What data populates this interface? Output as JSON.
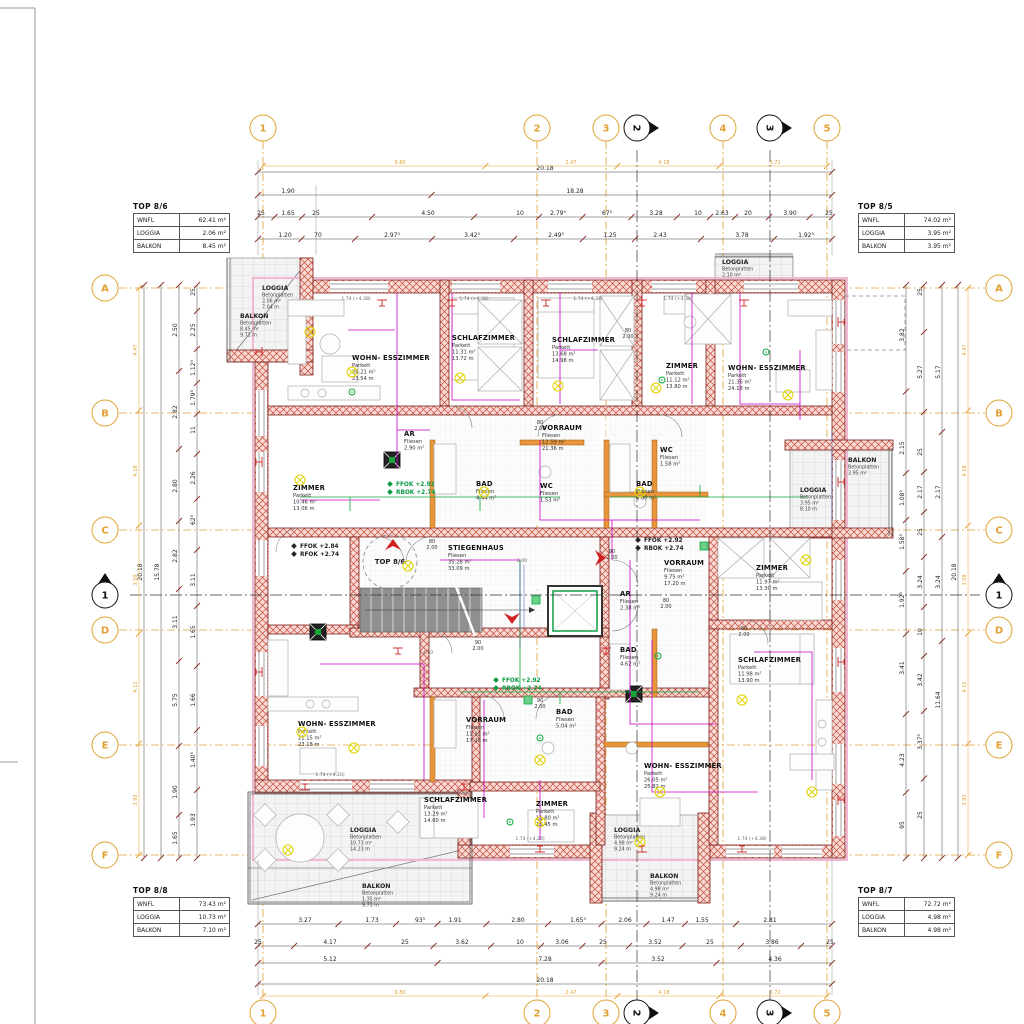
{
  "axes": {
    "cols": [
      {
        "label": "1",
        "x": 263
      },
      {
        "label": "2",
        "x": 537
      },
      {
        "label": "3",
        "x": 606
      },
      {
        "label": "4",
        "x": 723
      },
      {
        "label": "5",
        "x": 827
      }
    ],
    "rows": [
      {
        "label": "A",
        "y": 288
      },
      {
        "label": "B",
        "y": 413
      },
      {
        "label": "C",
        "y": 530
      },
      {
        "label": "D",
        "y": 630
      },
      {
        "label": "E",
        "y": 745
      },
      {
        "label": "F",
        "y": 855
      }
    ],
    "sections": [
      {
        "label": "1",
        "type": "h",
        "pos": 595
      },
      {
        "label": "2",
        "type": "v",
        "pos": 637
      },
      {
        "label": "3",
        "type": "v",
        "pos": 770
      }
    ]
  },
  "tables": [
    {
      "title": "TOP 8/6",
      "rows": [
        {
          "k": "WNFL",
          "v": "62.41 m²"
        },
        {
          "k": "LOGGIA",
          "v": "2.06 m²"
        },
        {
          "k": "BALKON",
          "v": "8.45 m²"
        }
      ]
    },
    {
      "title": "TOP 8/5",
      "rows": [
        {
          "k": "WNFL",
          "v": "74.02 m²"
        },
        {
          "k": "LOGGIA",
          "v": "3.95 m²"
        },
        {
          "k": "BALKON",
          "v": "3.95 m²"
        }
      ]
    },
    {
      "title": "TOP 8/8",
      "rows": [
        {
          "k": "WNFL",
          "v": "73.43 m²"
        },
        {
          "k": "LOGGIA",
          "v": "10.73 m²"
        },
        {
          "k": "BALKON",
          "v": "7.10 m²"
        }
      ]
    },
    {
      "title": "TOP 8/7",
      "rows": [
        {
          "k": "WNFL",
          "v": "72.72 m²"
        },
        {
          "k": "LOGGIA",
          "v": "4.98 m²"
        },
        {
          "k": "BALKON",
          "v": "4.98 m²"
        }
      ]
    }
  ],
  "rooms": [
    {
      "name": "WOHN- ESSZIMMER",
      "lines": [
        "Parkett",
        "26.21 m²",
        "23.54 m"
      ],
      "x": 352,
      "y": 360
    },
    {
      "name": "SCHLAFZIMMER",
      "lines": [
        "Parkett",
        "11.31 m²",
        "13.72 m"
      ],
      "x": 452,
      "y": 340
    },
    {
      "name": "SCHLAFZIMMER",
      "lines": [
        "Parkett",
        "13.68 m²",
        "14.98 m"
      ],
      "x": 552,
      "y": 342
    },
    {
      "name": "ZIMMER",
      "lines": [
        "Parkett",
        "11.12 m²",
        "13.80 m"
      ],
      "x": 666,
      "y": 368
    },
    {
      "name": "WOHN- ESSZIMMER",
      "lines": [
        "Parkett",
        "21.36 m²",
        "24.18 m"
      ],
      "x": 728,
      "y": 370
    },
    {
      "name": "ZIMMER",
      "lines": [
        "Parkett",
        "10.46 m²",
        "13.06 m"
      ],
      "x": 293,
      "y": 490
    },
    {
      "name": "VORRAUM",
      "lines": [
        "Fliesen",
        "12.59 m²",
        "21.36 m"
      ],
      "x": 542,
      "y": 430
    },
    {
      "name": "VORRAUM",
      "lines": [
        "Fliesen",
        "9.75 m²",
        "17.20 m"
      ],
      "x": 664,
      "y": 565
    },
    {
      "name": "ZIMMER",
      "lines": [
        "Parkett",
        "11.97 m²",
        "13.30 m"
      ],
      "x": 756,
      "y": 570
    },
    {
      "name": "STIEGENHAUS",
      "lines": [
        "Fliesen",
        "35.28 m²",
        "33.09 m"
      ],
      "x": 448,
      "y": 550
    },
    {
      "name": "VORRAUM",
      "lines": [
        "Fliesen",
        "11.32 m²",
        "17.20 m"
      ],
      "x": 466,
      "y": 722
    },
    {
      "name": "WOHN- ESSZIMMER",
      "lines": [
        "Parkett",
        "21.15 m²",
        "23.18 m"
      ],
      "x": 298,
      "y": 726
    },
    {
      "name": "SCHLAFZIMMER",
      "lines": [
        "Parkett",
        "11.98 m²",
        "13.90 m"
      ],
      "x": 738,
      "y": 662
    },
    {
      "name": "WOHN- ESSZIMMER",
      "lines": [
        "Parkett",
        "26.05 m²",
        "25.82 m"
      ],
      "x": 644,
      "y": 768
    },
    {
      "name": "SCHLAFZIMMER",
      "lines": [
        "Parkett",
        "13.29 m²",
        "14.60 m"
      ],
      "x": 424,
      "y": 802
    },
    {
      "name": "ZIMMER",
      "lines": [
        "Parkett",
        "11.80 m²",
        "13.45 m"
      ],
      "x": 536,
      "y": 806
    },
    {
      "name": "BAD",
      "lines": [
        "Fliesen",
        "4.44 m²"
      ],
      "x": 476,
      "y": 486
    },
    {
      "name": "WC",
      "lines": [
        "Fliesen",
        "1.53 m²"
      ],
      "x": 540,
      "y": 488
    },
    {
      "name": "BAD",
      "lines": [
        "Fliesen",
        "4.80 m²"
      ],
      "x": 636,
      "y": 486
    },
    {
      "name": "AR",
      "lines": [
        "Fliesen",
        "2.38 m²"
      ],
      "x": 620,
      "y": 596
    },
    {
      "name": "BAD",
      "lines": [
        "Fliesen",
        "5.04 m²"
      ],
      "x": 556,
      "y": 714
    },
    {
      "name": "BAD",
      "lines": [
        "Fliesen",
        "4.62 m²"
      ],
      "x": 620,
      "y": 652
    },
    {
      "name": "AR",
      "lines": [
        "Fliesen",
        "2.90 m²"
      ],
      "x": 404,
      "y": 436
    },
    {
      "name": "WC",
      "lines": [
        "Fliesen",
        "1.58 m²"
      ],
      "x": 660,
      "y": 452
    }
  ],
  "loggias": [
    {
      "name": "LOGGIA",
      "lines": [
        "Betonplatten",
        "2.06 m²",
        "7.04 m"
      ],
      "x": 262,
      "y": 290
    },
    {
      "name": "BALKON",
      "lines": [
        "Betonplatten",
        "8.45 m²",
        "9.71 m"
      ],
      "x": 240,
      "y": 318
    },
    {
      "name": "LOGGIA",
      "lines": [
        "Betonplatten",
        "3.95 m²",
        "8.10 m"
      ],
      "x": 800,
      "y": 492
    },
    {
      "name": "BALKON",
      "lines": [
        "Betonplatten",
        "3.95 m²"
      ],
      "x": 848,
      "y": 462
    },
    {
      "name": "LOGGIA",
      "lines": [
        "Betonplatten",
        "10.73 m²",
        "14.23 m"
      ],
      "x": 350,
      "y": 832
    },
    {
      "name": "BALKON",
      "lines": [
        "Betonplatten",
        "1.35 m²",
        "9.71 m"
      ],
      "x": 362,
      "y": 888
    },
    {
      "name": "LOGGIA",
      "lines": [
        "Betonplatten",
        "4.98 m²",
        "9.24 m"
      ],
      "x": 614,
      "y": 832
    },
    {
      "name": "BALKON",
      "lines": [
        "Betonplatten",
        "4.98 m²",
        "9.24 m"
      ],
      "x": 650,
      "y": 878
    },
    {
      "name": "LOGGIA",
      "lines": [
        "Betonplatten",
        "2.10 m²"
      ],
      "x": 722,
      "y": 264
    }
  ],
  "annotations": [
    {
      "lines": [
        "FFOK +2.92",
        "RBOK +2.74"
      ],
      "x": 396,
      "y": 486,
      "color": "#0B9A44"
    },
    {
      "lines": [
        "FFOK +2.84",
        "RFOK +2.74"
      ],
      "x": 300,
      "y": 548,
      "color": "#222222"
    },
    {
      "lines": [
        "FFOK +2.92",
        "RBOK +2.74"
      ],
      "x": 644,
      "y": 542,
      "color": "#222222"
    },
    {
      "lines": [
        "FFOK +2.92",
        "RBOK +2.74"
      ],
      "x": 502,
      "y": 682,
      "color": "#0B9A44"
    }
  ],
  "entry_label": {
    "label": "TOP 8/6",
    "x": 390,
    "y": 562
  },
  "dims_top": [
    {
      "y": 172,
      "x1": 258,
      "x2": 832,
      "items": [
        {
          "t": "20.18",
          "x": 545
        }
      ]
    },
    {
      "y": 195,
      "x1": 258,
      "x2": 832,
      "items": [
        {
          "t": "1.90",
          "x": 288
        },
        {
          "t": "18.28",
          "x": 575
        }
      ]
    },
    {
      "y": 217,
      "x1": 258,
      "x2": 832,
      "items": [
        {
          "t": "25",
          "x": 261
        },
        {
          "t": "1.65",
          "x": 288
        },
        {
          "t": "25",
          "x": 316
        },
        {
          "t": "4.50",
          "x": 428
        },
        {
          "t": "10",
          "x": 520
        },
        {
          "t": "2.79⁵",
          "x": 558
        },
        {
          "t": "67⁵",
          "x": 607
        },
        {
          "t": "3.28",
          "x": 656
        },
        {
          "t": "10",
          "x": 698
        },
        {
          "t": "2.63",
          "x": 722
        },
        {
          "t": "20",
          "x": 748
        },
        {
          "t": "3.90",
          "x": 790
        },
        {
          "t": "25",
          "x": 829
        }
      ]
    },
    {
      "y": 239,
      "x1": 258,
      "x2": 832,
      "items": [
        {
          "t": "1.20",
          "x": 285
        },
        {
          "t": "70",
          "x": 318
        },
        {
          "t": "2.97⁵",
          "x": 392
        },
        {
          "t": "3.42⁵",
          "x": 472
        },
        {
          "t": "2.49⁵",
          "x": 556
        },
        {
          "t": "1.25",
          "x": 610
        },
        {
          "t": "2.43",
          "x": 660
        },
        {
          "t": "3.78",
          "x": 742
        },
        {
          "t": "1.92⁵",
          "x": 806
        }
      ]
    }
  ],
  "dims_bottom": [
    {
      "y": 924,
      "x1": 258,
      "x2": 832,
      "items": [
        {
          "t": "3.27",
          "x": 305
        },
        {
          "t": "1.73",
          "x": 372
        },
        {
          "t": "93⁵",
          "x": 420
        },
        {
          "t": "1.91",
          "x": 455
        },
        {
          "t": "2.80",
          "x": 518
        },
        {
          "t": "1.65⁵",
          "x": 578
        },
        {
          "t": "2.06",
          "x": 625
        },
        {
          "t": "1.47",
          "x": 668
        },
        {
          "t": "1.55",
          "x": 702
        },
        {
          "t": "2.81",
          "x": 770
        }
      ]
    },
    {
      "y": 946,
      "x1": 258,
      "x2": 832,
      "items": [
        {
          "t": "25",
          "x": 258
        },
        {
          "t": "4.17",
          "x": 330
        },
        {
          "t": "25",
          "x": 405
        },
        {
          "t": "3.62",
          "x": 462
        },
        {
          "t": "10",
          "x": 520
        },
        {
          "t": "3.06",
          "x": 562
        },
        {
          "t": "25",
          "x": 603
        },
        {
          "t": "3.52",
          "x": 655
        },
        {
          "t": "25",
          "x": 710
        },
        {
          "t": "3.86",
          "x": 772
        },
        {
          "t": "25",
          "x": 830
        }
      ]
    },
    {
      "y": 963,
      "x1": 258,
      "x2": 832,
      "items": [
        {
          "t": "5.12",
          "x": 330
        },
        {
          "t": "7.28",
          "x": 545
        },
        {
          "t": "3.52",
          "x": 658
        },
        {
          "t": "4.36",
          "x": 775
        }
      ]
    },
    {
      "y": 984,
      "x1": 258,
      "x2": 832,
      "items": [
        {
          "t": "20.18",
          "x": 545
        }
      ]
    }
  ],
  "dims_left": [
    {
      "x": 144,
      "y1": 285,
      "y2": 858,
      "items": [
        {
          "t": "20.18",
          "y": 572
        }
      ]
    },
    {
      "x": 161,
      "y1": 285,
      "y2": 858,
      "items": [
        {
          "t": "15.78",
          "y": 572
        }
      ]
    },
    {
      "x": 179,
      "y1": 285,
      "y2": 858,
      "items": [
        {
          "t": "2.50",
          "y": 330
        },
        {
          "t": "2.82",
          "y": 412
        },
        {
          "t": "2.80",
          "y": 486
        },
        {
          "t": "2.82",
          "y": 556
        },
        {
          "t": "3.11",
          "y": 622
        },
        {
          "t": "5.75",
          "y": 700
        },
        {
          "t": "1.90",
          "y": 792
        },
        {
          "t": "1.65",
          "y": 838
        }
      ]
    },
    {
      "x": 197,
      "y1": 285,
      "y2": 858,
      "items": [
        {
          "t": "25",
          "y": 292
        },
        {
          "t": "2.25",
          "y": 330
        },
        {
          "t": "1.12⁵",
          "y": 368
        },
        {
          "t": "1.79⁵",
          "y": 398
        },
        {
          "t": "11",
          "y": 430
        },
        {
          "t": "2.26",
          "y": 478
        },
        {
          "t": "62⁵",
          "y": 520
        },
        {
          "t": "3.11",
          "y": 580
        },
        {
          "t": "1.65",
          "y": 632
        },
        {
          "t": "1.66",
          "y": 700
        },
        {
          "t": "1.40⁵",
          "y": 760
        },
        {
          "t": "1.93",
          "y": 820
        }
      ]
    }
  ],
  "dims_right": [
    {
      "x": 906,
      "y1": 285,
      "y2": 858,
      "items": [
        {
          "t": "3.82",
          "y": 335
        },
        {
          "t": "2.15",
          "y": 448
        },
        {
          "t": "1.08⁵",
          "y": 498
        },
        {
          "t": "1.58⁵",
          "y": 542
        },
        {
          "t": "1.92⁵",
          "y": 600
        },
        {
          "t": "3.41",
          "y": 668
        },
        {
          "t": "4.23",
          "y": 760
        },
        {
          "t": "95",
          "y": 825
        }
      ]
    },
    {
      "x": 924,
      "y1": 285,
      "y2": 858,
      "items": [
        {
          "t": "25",
          "y": 292
        },
        {
          "t": "5.27",
          "y": 372
        },
        {
          "t": "25",
          "y": 452
        },
        {
          "t": "2.17",
          "y": 492
        },
        {
          "t": "25",
          "y": 532
        },
        {
          "t": "3.24",
          "y": 582
        },
        {
          "t": "10",
          "y": 632
        },
        {
          "t": "3.42",
          "y": 680
        },
        {
          "t": "3.37⁵",
          "y": 742
        },
        {
          "t": "25",
          "y": 815
        }
      ]
    },
    {
      "x": 942,
      "y1": 285,
      "y2": 858,
      "items": [
        {
          "t": "5.17",
          "y": 372
        },
        {
          "t": "2.17",
          "y": 492
        },
        {
          "t": "3.24",
          "y": 582
        },
        {
          "t": "11.64",
          "y": 700
        }
      ]
    },
    {
      "x": 958,
      "y1": 285,
      "y2": 858,
      "items": [
        {
          "t": "20.18",
          "y": 572
        }
      ]
    }
  ],
  "axis_chain_top": {
    "y": 166,
    "x1": 263,
    "x2": 827,
    "items": [
      {
        "t": "9.80",
        "x": 400
      },
      {
        "t": "2.47",
        "x": 571
      },
      {
        "t": "4.18",
        "x": 664
      },
      {
        "t": "3.72",
        "x": 775
      }
    ]
  },
  "axis_chain_bottom": {
    "y": 996,
    "x1": 263,
    "x2": 827,
    "items": [
      {
        "t": "9.80",
        "x": 400
      },
      {
        "t": "2.47",
        "x": 571
      },
      {
        "t": "4.18",
        "x": 664
      },
      {
        "t": "3.72",
        "x": 775
      }
    ]
  },
  "axis_chain_left": {
    "x": 139,
    "y1": 288,
    "y2": 855,
    "items": [
      {
        "t": "4.47",
        "y": 350
      },
      {
        "t": "4.18",
        "y": 471
      },
      {
        "t": "3.58",
        "y": 580
      },
      {
        "t": "4.11",
        "y": 687
      },
      {
        "t": "3.93",
        "y": 800
      }
    ]
  },
  "axis_chain_right": {
    "x": 968,
    "y1": 288,
    "y2": 855,
    "items": [
      {
        "t": "4.47",
        "y": 350
      },
      {
        "t": "4.18",
        "y": 471
      },
      {
        "t": "3.58",
        "y": 580
      },
      {
        "t": "4.11",
        "y": 687
      },
      {
        "t": "3.93",
        "y": 800
      }
    ]
  },
  "door_tags": [
    {
      "a": "80",
      "b": "2.00",
      "x": 432,
      "y": 543
    },
    {
      "a": "90",
      "b": "2.00",
      "x": 612,
      "y": 553
    },
    {
      "a": "80",
      "b": "2.00",
      "x": 540,
      "y": 424
    },
    {
      "a": "80",
      "b": "2.00",
      "x": 666,
      "y": 602
    },
    {
      "a": "90",
      "b": "2.00",
      "x": 478,
      "y": 644
    },
    {
      "a": "80",
      "b": "2.00",
      "x": 628,
      "y": 332
    },
    {
      "a": "90",
      "b": "2.00",
      "x": 540,
      "y": 702
    },
    {
      "a": "80",
      "b": "2.00",
      "x": 744,
      "y": 630
    }
  ],
  "window_tags": [
    {
      "t": "1.74 (+4.38)",
      "x": 356,
      "y": 300
    },
    {
      "t": "1.74 (+4.38)",
      "x": 474,
      "y": 300
    },
    {
      "t": "1.74 (+4.38)",
      "x": 588,
      "y": 300
    },
    {
      "t": "1.74 (+4.38)",
      "x": 678,
      "y": 300
    },
    {
      "t": "1.74 (+4.20)",
      "x": 330,
      "y": 776
    },
    {
      "t": "1.74 (+4.20)",
      "x": 530,
      "y": 840
    },
    {
      "t": "1.74 (+4.38)",
      "x": 752,
      "y": 840
    },
    {
      "t": "4.50",
      "x": 428,
      "y": 654
    },
    {
      "t": "2.00",
      "x": 522,
      "y": 562
    }
  ]
}
